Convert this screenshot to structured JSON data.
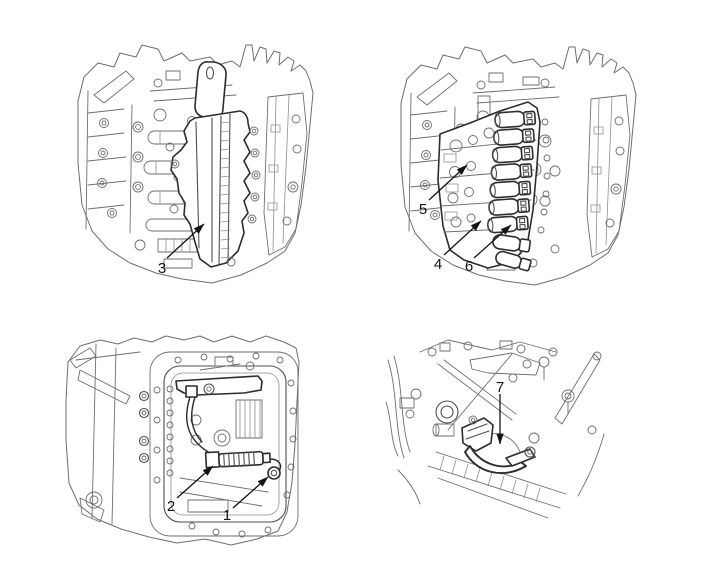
{
  "figure": {
    "kind": "technical-line-diagram",
    "background_color": "#ffffff",
    "line_color": "#6e6e6e",
    "emphasis_line_color": "#2d2d2d",
    "callout_color": "#141414"
  },
  "panels": [
    {
      "position": "top-left",
      "callouts": [
        {
          "label": "3"
        }
      ]
    },
    {
      "position": "top-right",
      "callouts": [
        {
          "label": "5"
        },
        {
          "label": "4"
        },
        {
          "label": "6"
        }
      ]
    },
    {
      "position": "bottom-left",
      "callouts": [
        {
          "label": "2"
        },
        {
          "label": "1"
        }
      ]
    },
    {
      "position": "bottom-right",
      "callouts": [
        {
          "label": "7"
        }
      ]
    }
  ]
}
